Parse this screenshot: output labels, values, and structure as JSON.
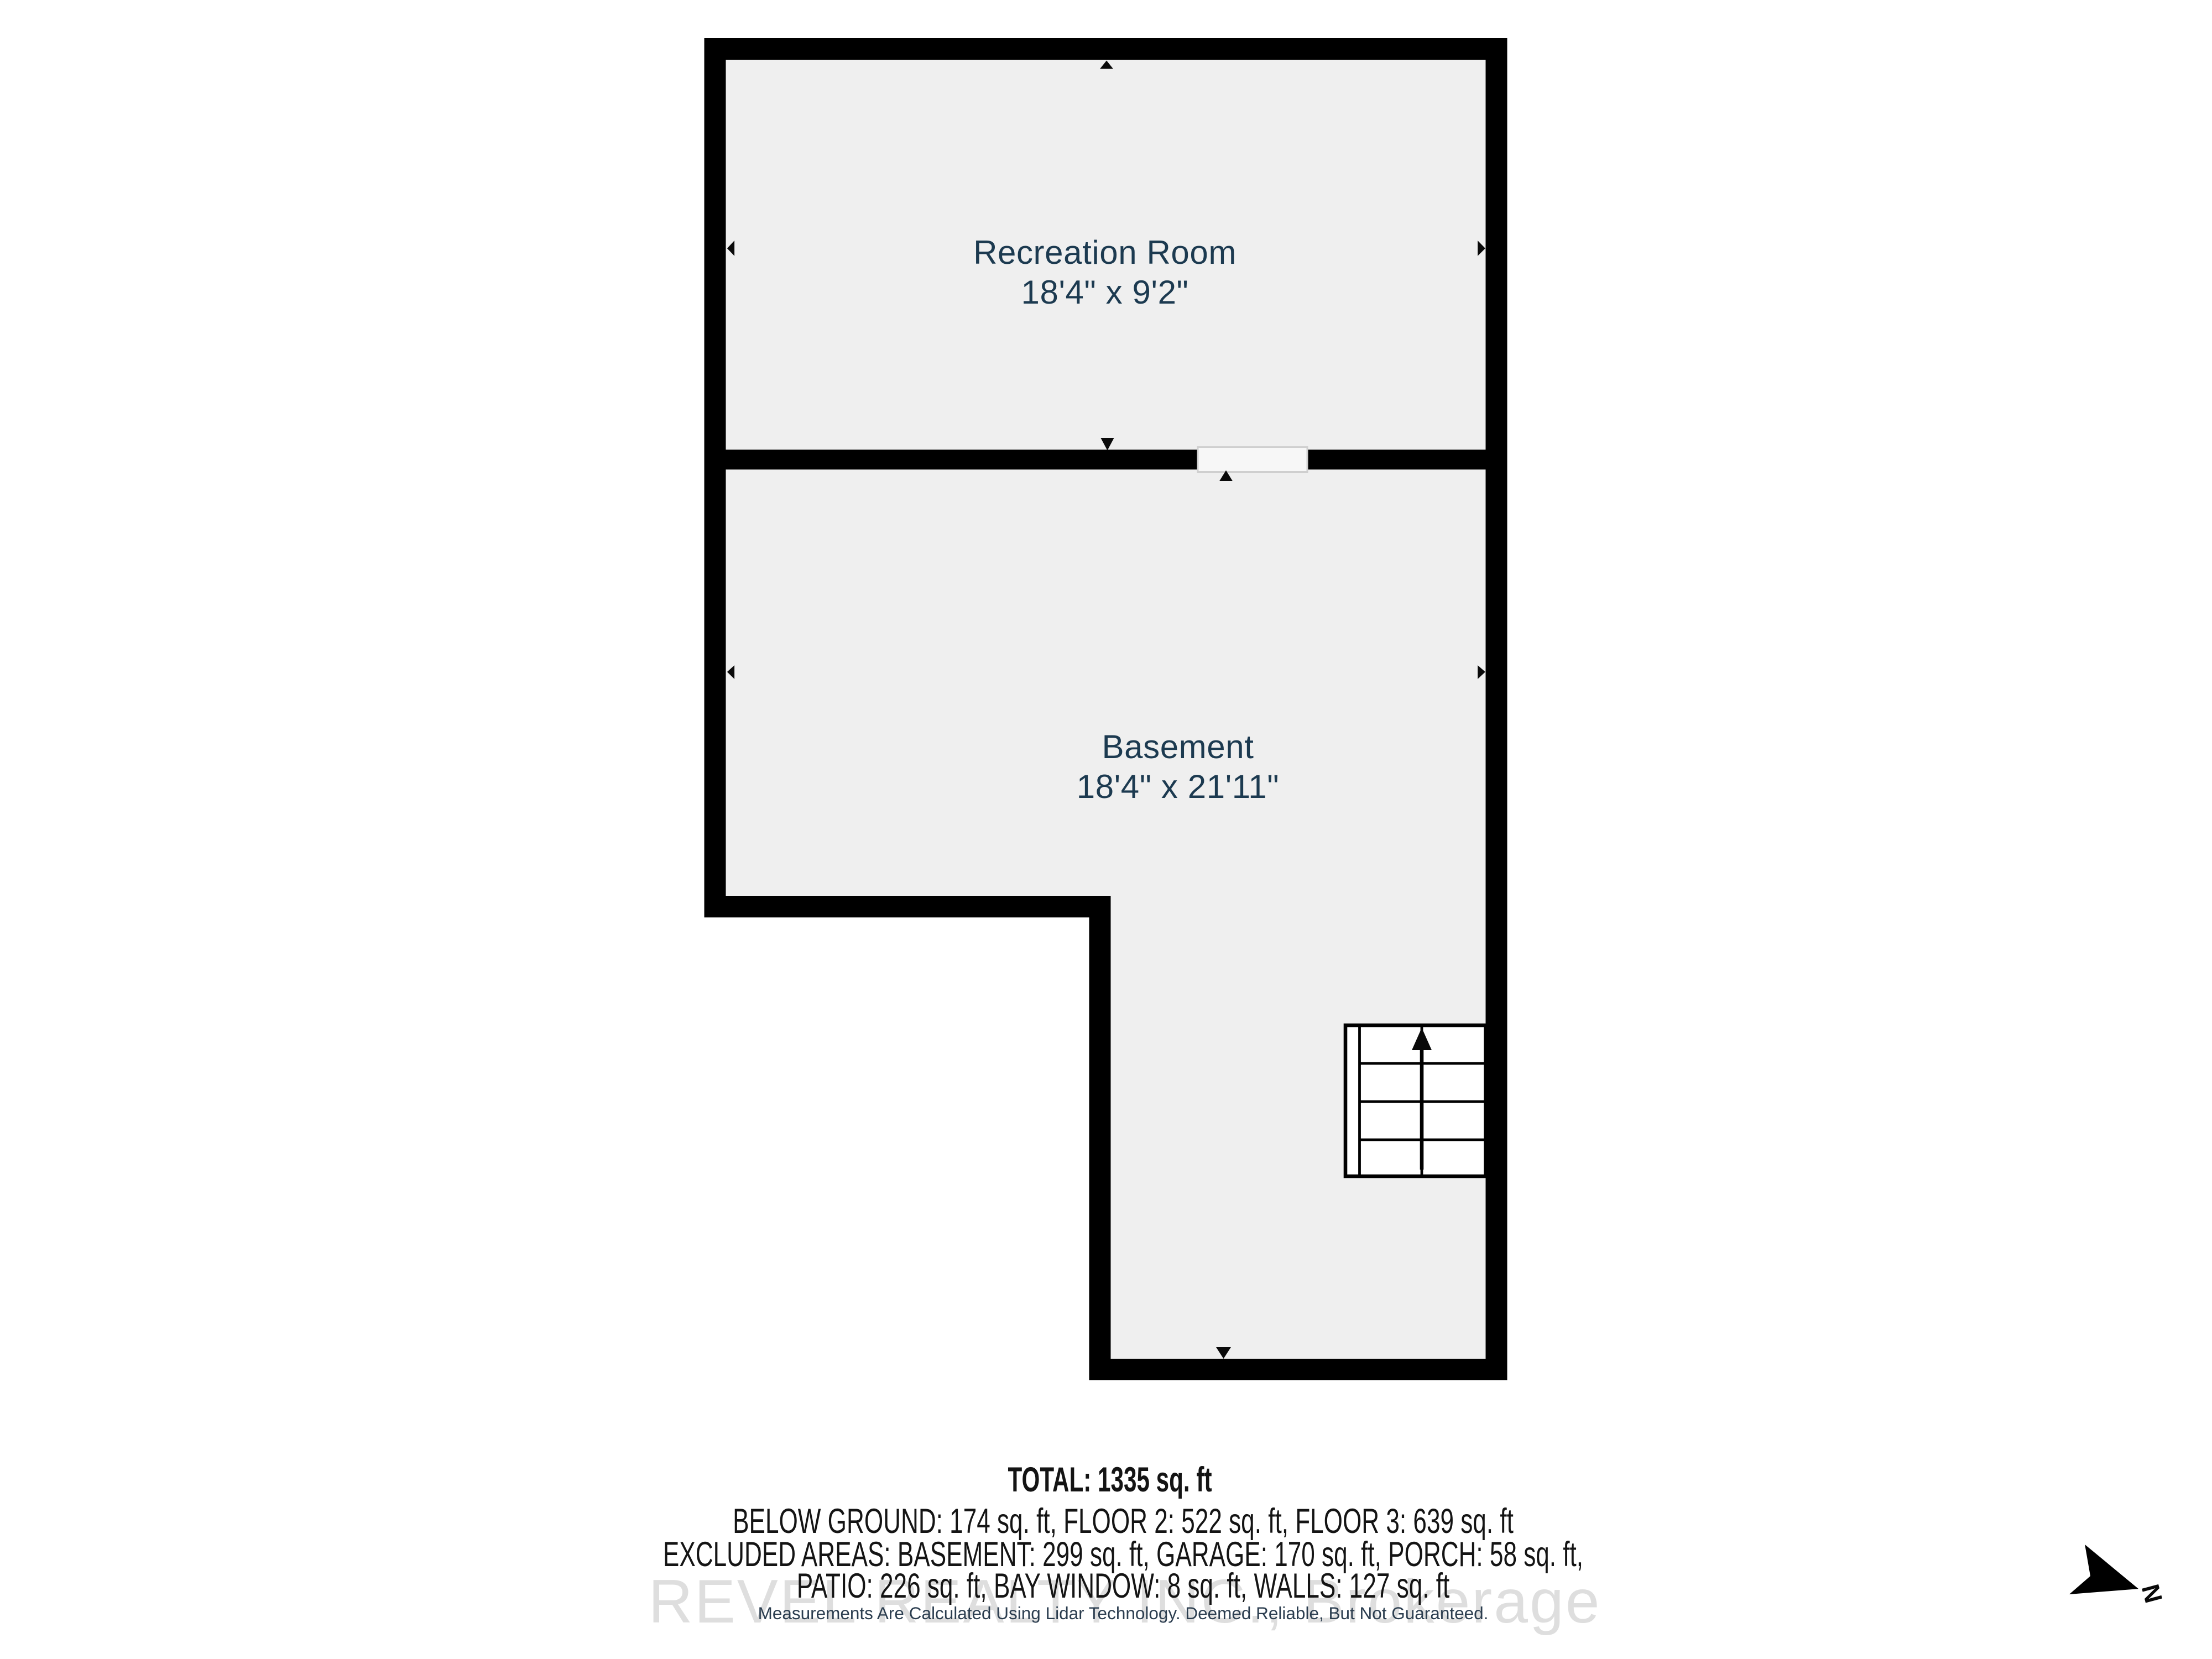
{
  "plan": {
    "rooms": [
      {
        "name": "Recreation Room",
        "dimensions": "18'4\" x 9'2\""
      },
      {
        "name": "Basement",
        "dimensions": "18'4\" x 21'11\""
      }
    ],
    "compass": {
      "label": "N"
    }
  },
  "summary": {
    "total": "TOTAL: 1335 sq. ft",
    "floors": "BELOW GROUND: 174 sq. ft, FLOOR 2: 522 sq. ft, FLOOR 3: 639 sq. ft",
    "excluded_line1": "EXCLUDED AREAS: BASEMENT: 299 sq. ft, GARAGE: 170 sq. ft, PORCH: 58 sq. ft,",
    "excluded_line2": "PATIO: 226 sq. ft, BAY WINDOW: 8 sq. ft, WALLS: 127 sq. ft"
  },
  "watermark": "REVEL REALTY INC., Brokerage",
  "disclaimer": "Measurements Are Calculated Using Lidar Technology. Deemed Reliable, But Not Guaranteed.",
  "colors": {
    "wall": "#000000",
    "floor_fill": "#efefef",
    "room_label_text": "#1c3a50",
    "summary_text": "#141414",
    "watermark_gray": "#dedede",
    "disclaimer_text": "#2b3d4f"
  }
}
